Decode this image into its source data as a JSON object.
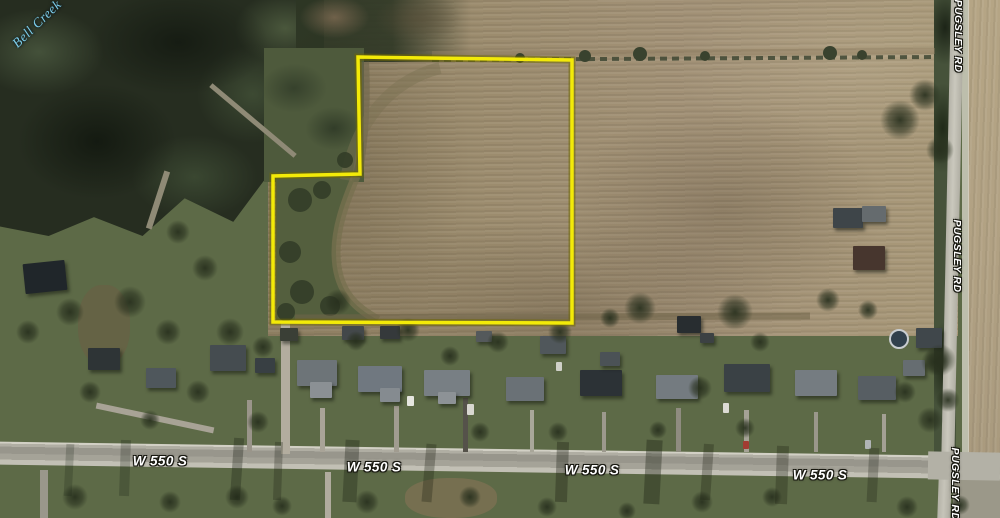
{
  "map": {
    "description": "Aerial photo with highlighted farm parcel at W 550 S and Pugsley Rd",
    "labels": {
      "creek": "Bell Creek",
      "road_horizontal": "W 550 S",
      "road_vertical": "PUGSLEY RD"
    },
    "parcel_outline": {
      "points": "358,57 572,60 572,323 273,322 273,176 360,174",
      "color": "#f3ea08"
    },
    "palette": {
      "field": "#9c8c6e",
      "east_field": "#b1a183",
      "woods": "#262d20",
      "lawn": "#5d6a47",
      "road": "#aaa89d",
      "creek_label_color": "#7ccdea",
      "road_label_color": "#ffffff"
    }
  }
}
